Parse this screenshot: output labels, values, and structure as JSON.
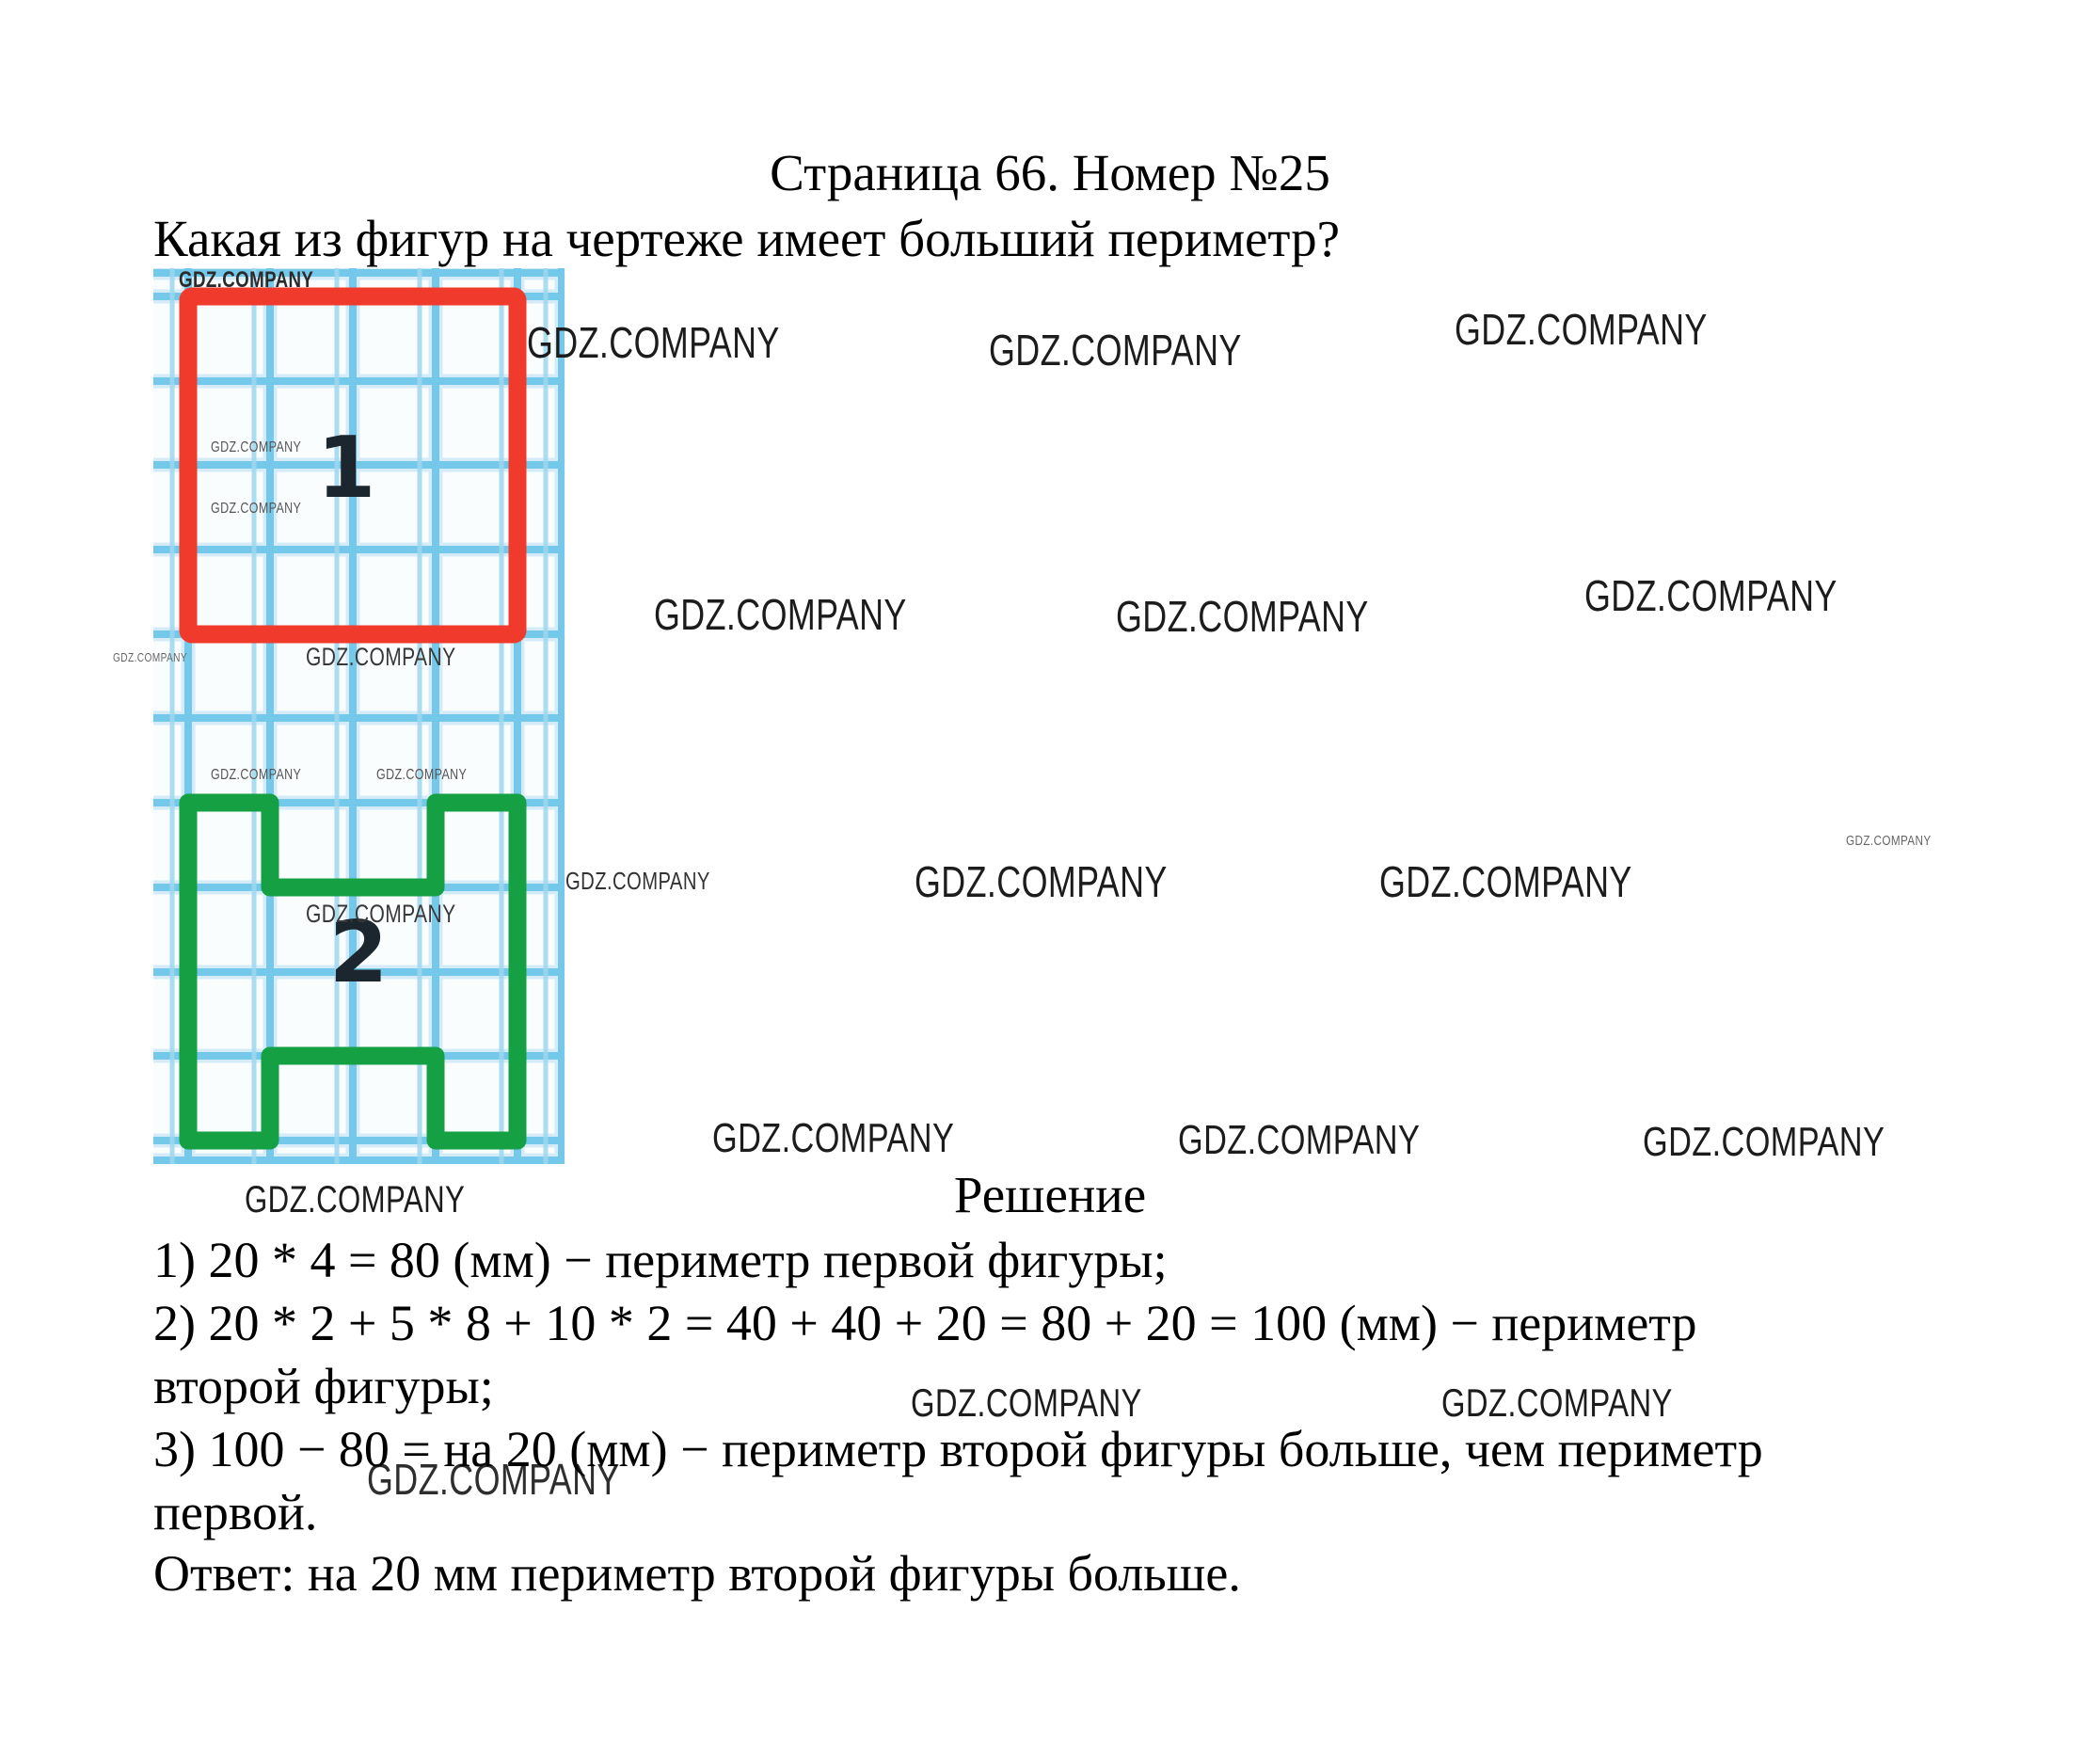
{
  "header": {
    "title": "Страница 66. Номер №25",
    "question": "Какая из фигур на чертеже имеет больший периметр?"
  },
  "figure": {
    "label_1": "1",
    "label_2": "2",
    "colors": {
      "figure1": "#f03a2b",
      "figure2": "#16a044",
      "grid_line": "#74c8e9"
    }
  },
  "watermark": {
    "text": "GDZ.COMPANY"
  },
  "solution": {
    "heading": "Решение",
    "lines": [
      "1) 20 * 4 = 80 (мм) − периметр первой фигуры;",
      "2) 20 * 2 + 5 * 8 + 10 * 2 = 40 + 40 + 20 = 80 + 20 = 100 (мм) − периметр",
      "второй фигуры;",
      "3) 100 − 80 = на 20 (мм) − периметр второй фигуры больше, чем периметр",
      "первой."
    ],
    "answer": "Ответ: на 20 мм периметр второй фигуры больше."
  }
}
